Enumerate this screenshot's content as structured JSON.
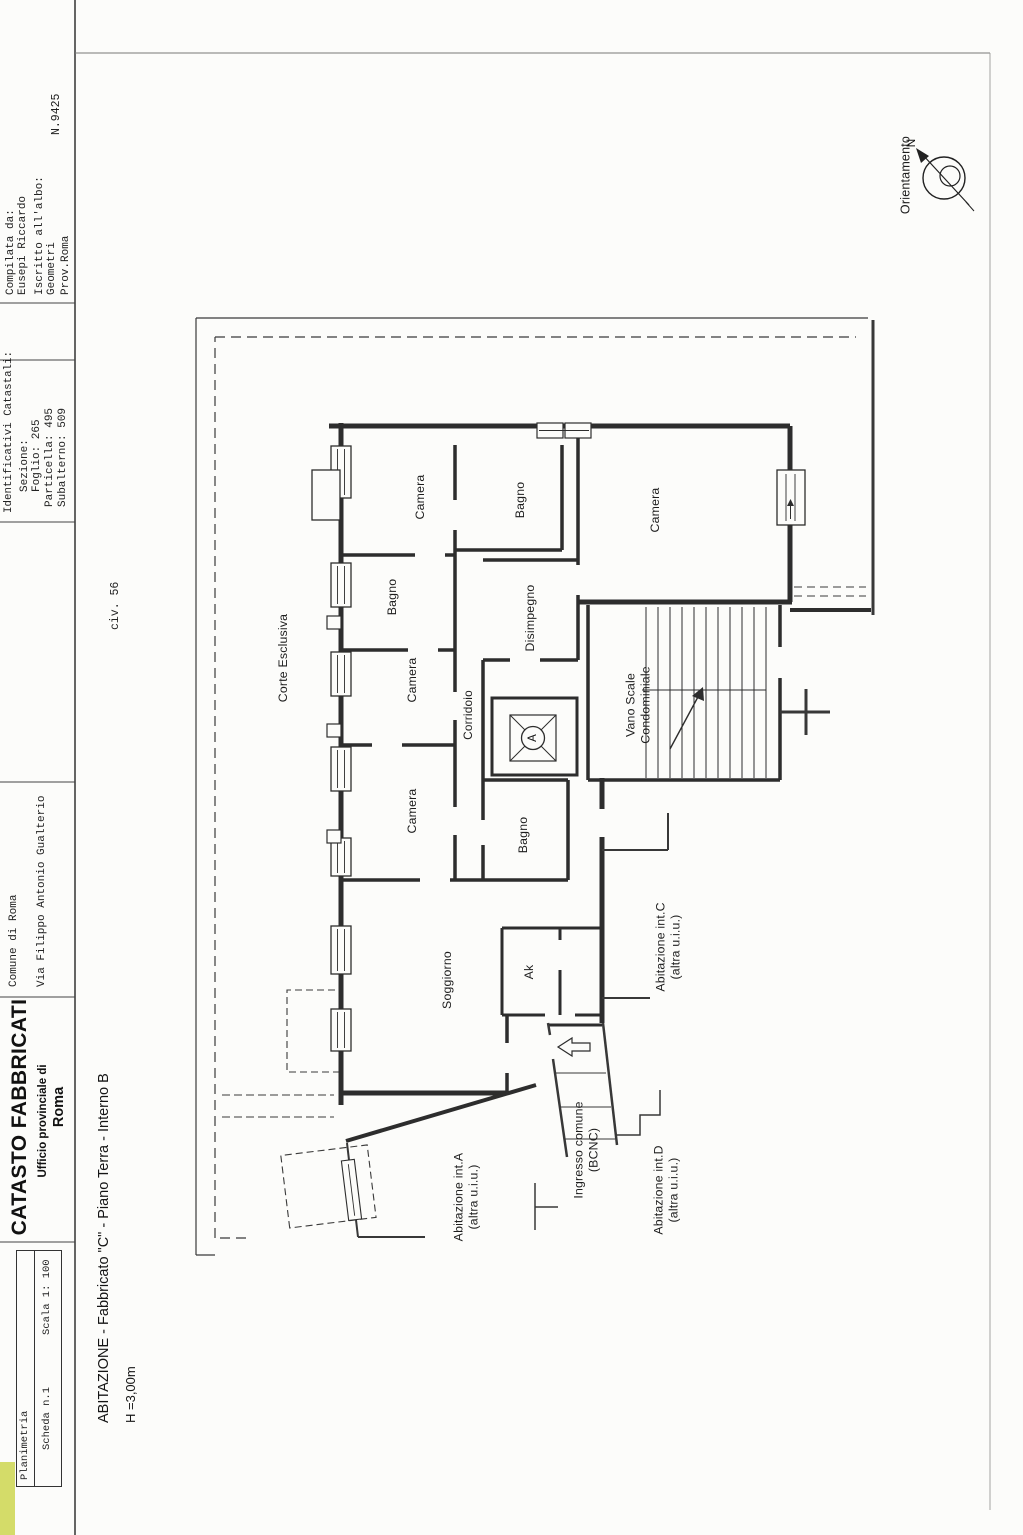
{
  "header": {
    "planimetria_box": {
      "row1": "Planimetria",
      "scheda": "Scheda n.1",
      "scala": "Scala 1: 100"
    },
    "catasto": {
      "title": "CATASTO FABBRICATI",
      "subtitle": "Ufficio provinciale di",
      "city": "Roma"
    },
    "location": {
      "comune": "Comune di Roma",
      "via": "Via Filippo Antonio Gualterio"
    },
    "identificativi": {
      "title": "Identificativi Catastali:",
      "sezione": "Sezione:",
      "foglio": "Foglio: 265",
      "particella": "Particella: 495",
      "subalterno": "Subalterno: 509"
    },
    "compilata": {
      "label": "Compilata da:",
      "name": "Eusepi Riccardo",
      "albo": "Iscritto all'albo:",
      "albo2": "Geometri",
      "prov": "Prov.Roma",
      "numero": "N.9425"
    }
  },
  "caption": {
    "line1": "ABITAZIONE - Fabbricato \"C\" - Piano Terra - Interno B",
    "line2": "H =3,00m"
  },
  "plan": {
    "civico": "civ. 56",
    "rooms": {
      "corte": "Corte Esclusiva",
      "camera": "Camera",
      "bagno": "Bagno",
      "corridoio": "Corridoio",
      "disimpegno": "Disimpegno",
      "soggiorno": "Soggiorno",
      "ak": "Ak",
      "vano_scale_1": "Vano Scale",
      "vano_scale_2": "Condominiale",
      "abit_a": "Abitazione int.A",
      "abit_c": "Abitazione int.C",
      "abit_d": "Abitazione int.D",
      "altra": "(altra u.i.u.)",
      "ingresso_1": "Ingresso comune",
      "ingresso_2": "(BCNC)",
      "elevator": "A"
    },
    "compass": {
      "label": "Orientamento",
      "north": "N"
    }
  }
}
